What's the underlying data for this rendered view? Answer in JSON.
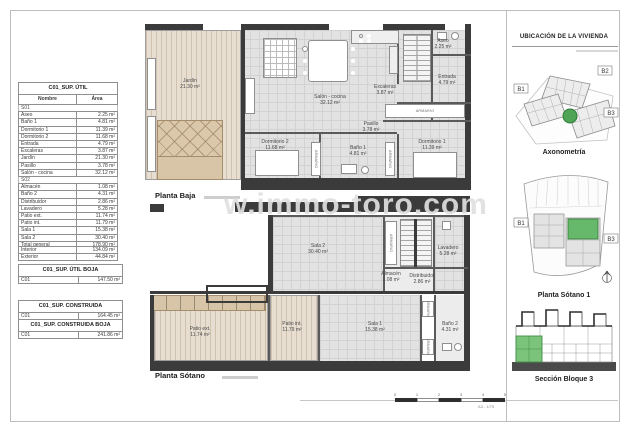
{
  "watermark": "w.immo-toro.com",
  "tables": {
    "util": {
      "title": "C01_SUP. ÚTIL",
      "col_name": "Nombre",
      "col_area": "Área",
      "group1": "S01",
      "rows1": [
        {
          "name": "Aseo",
          "area": "2.25 m²"
        },
        {
          "name": "Baño 1",
          "area": "4.81 m²"
        },
        {
          "name": "Dormitorio 1",
          "area": "11.39 m²"
        },
        {
          "name": "Dormitorio 2",
          "area": "11.68 m²"
        },
        {
          "name": "Entrada",
          "area": "4.79 m²"
        },
        {
          "name": "Escaleras",
          "area": "3.87 m²"
        },
        {
          "name": "Jardín",
          "area": "21.30 m²"
        },
        {
          "name": "Pasillo",
          "area": "3.78 m²"
        },
        {
          "name": "Salón - cocina",
          "area": "32.12 m²"
        }
      ],
      "group2": "S02",
      "rows2": [
        {
          "name": "Almacén",
          "area": "1.08 m²"
        },
        {
          "name": "Baño 2",
          "area": "4.31 m²"
        },
        {
          "name": "Distribuidor",
          "area": "2.86 m²"
        },
        {
          "name": "Lavadero",
          "area": "5.28 m²"
        },
        {
          "name": "Patio ext.",
          "area": "11.74 m²"
        },
        {
          "name": "Patio int.",
          "area": "11.79 m²"
        },
        {
          "name": "Sala 1",
          "area": "15.38 m²"
        },
        {
          "name": "Sala 2",
          "area": "30.40 m²"
        }
      ],
      "total_label": "Total general",
      "total_area": "178.90 m²",
      "interior_label": "Interior",
      "interior_area": "134.09 m²",
      "exterior_label": "Exterior",
      "exterior_area": "44.84 m²"
    },
    "util_boja": {
      "title": "C01_SUP. ÚTIL BOJA",
      "row_label": "C01",
      "value": "147.50 m²"
    },
    "construida": {
      "title": "C01_SUP. CONSTRUIDA",
      "row_label": "C01",
      "value": "164.45 m²"
    },
    "construida_boja": {
      "title": "C01_SUP. CONSTRUIDA BOJA",
      "row_label": "C01",
      "value": "241.86 m²"
    }
  },
  "plans": {
    "baja": {
      "label": "Planta Baja",
      "armario": "ARMARIO",
      "rooms": [
        {
          "name": "Jardín",
          "area": "21.30 m²"
        },
        {
          "name": "Salón - cocina",
          "area": "32.12 m²"
        },
        {
          "name": "Escaleras",
          "area": "3.87 m²"
        },
        {
          "name": "Aseo",
          "area": "2.25 m²"
        },
        {
          "name": "Entrada",
          "area": "4.79 m²"
        },
        {
          "name": "Pasillo",
          "area": "3.78 m²"
        },
        {
          "name": "Baño 1",
          "area": "4.81 m²"
        },
        {
          "name": "Dormitorio 1",
          "area": "11.39 m²"
        },
        {
          "name": "Dormitorio 2",
          "area": "11.68 m²"
        }
      ]
    },
    "sotano": {
      "label": "Planta Sótano",
      "armario": "ARMARIO",
      "rooms": [
        {
          "name": "Sala 2",
          "area": "30.40 m²"
        },
        {
          "name": "Almacén",
          "area": "1.08 m²"
        },
        {
          "name": "Distribuidor",
          "area": "2.86 m²"
        },
        {
          "name": "Lavadero",
          "area": "5.28 m²"
        },
        {
          "name": "Patio ext.",
          "area": "11.74 m²"
        },
        {
          "name": "Patio int.",
          "area": "11.79 m²"
        },
        {
          "name": "Sala 1",
          "area": "15.38 m²"
        },
        {
          "name": "Baño 2",
          "area": "4.31 m²"
        }
      ]
    }
  },
  "sidebar": {
    "title": "UBICACIÓN DE LA VIVIENDA",
    "axon_label": "Axonometría",
    "sotano1_label": "Planta Sótano 1",
    "seccion_label": "Sección Bloque 3",
    "b1": "B1",
    "b2": "B2",
    "b3": "B3"
  },
  "scalebar": {
    "t0": "0",
    "t1": "1",
    "t2": "2",
    "t3": "3",
    "t4": "4",
    "t5": "5",
    "note": "A3 - 1/75"
  }
}
